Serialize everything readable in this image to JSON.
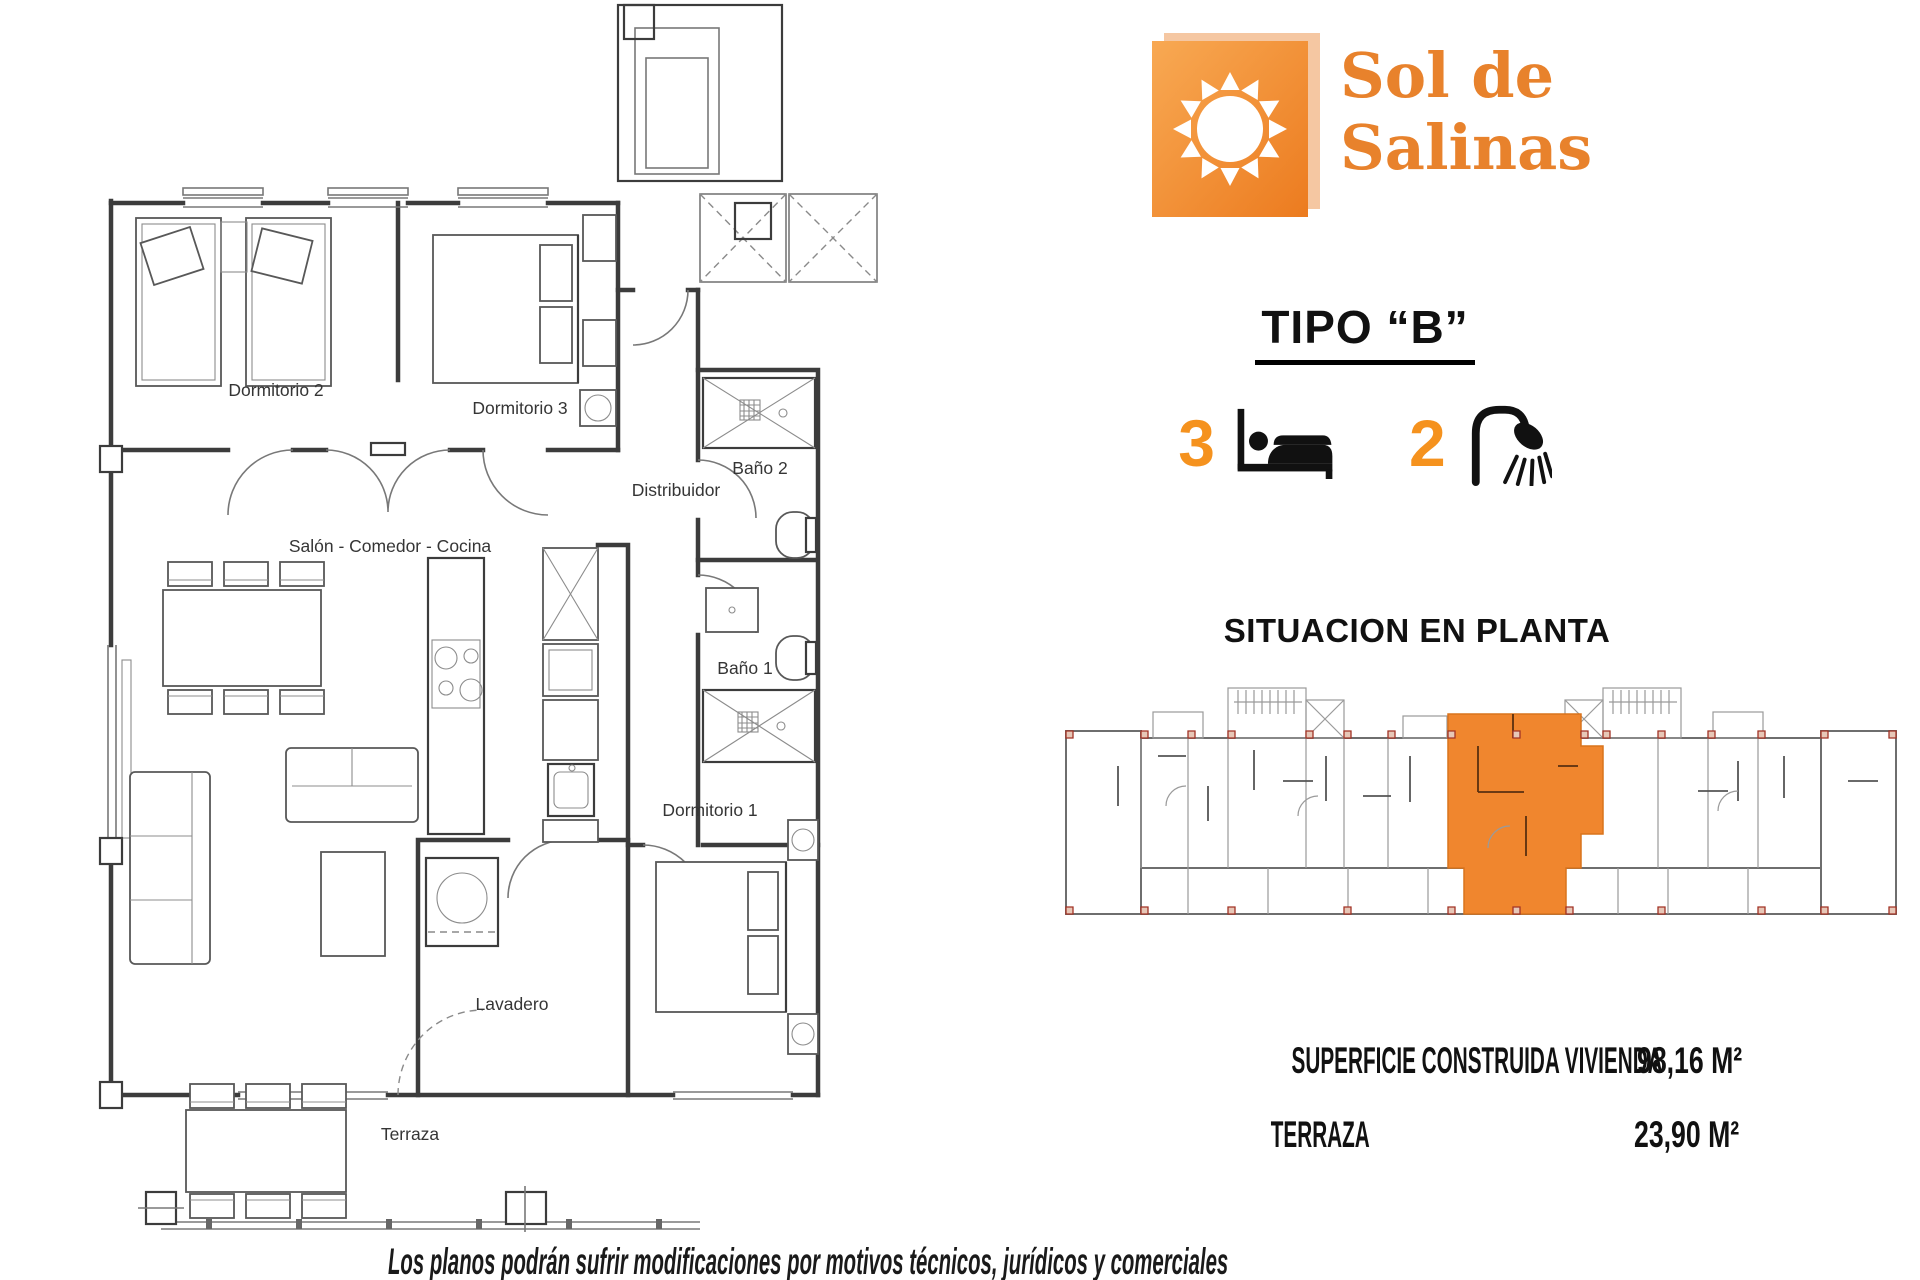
{
  "logo": {
    "line1": "Sol de",
    "line2": "Salinas"
  },
  "unit": {
    "type_title": "TIPO “B”",
    "bedrooms": "3",
    "bathrooms": "2"
  },
  "icons": {
    "bedrooms": "bed-icon",
    "bathrooms": "shower-icon",
    "logo": "sun-icon"
  },
  "situacion": {
    "title": "SITUACION EN PLANTA"
  },
  "areas": {
    "rows": [
      {
        "label": "SUPERFICIE CONSTRUIDA VIVIENDA",
        "value": "98,16 M²"
      },
      {
        "label": "TERRAZA",
        "value": "23,90 M²"
      }
    ]
  },
  "floor_plan": {
    "rooms": {
      "dormitorio2": "Dormitorio 2",
      "dormitorio3": "Dormitorio 3",
      "bano2": "Baño 2",
      "distribuidor": "Distribuidor",
      "salon": "Salón - Comedor - Cocina",
      "bano1": "Baño 1",
      "dormitorio1": "Dormitorio 1",
      "lavadero": "Lavadero",
      "terraza": "Terraza"
    }
  },
  "disclaimer": "Los planos podrán sufrir modificaciones por motivos técnicos, jurídicos y comerciales",
  "colors": {
    "brand_orange": "#EE7F26",
    "logo_text_orange": "#E8822C",
    "accent_number_orange": "#F5921E",
    "highlight_unit_orange": "#F0862E",
    "plan_line": "#3C3C3C",
    "pillar_red": "#A23325"
  }
}
